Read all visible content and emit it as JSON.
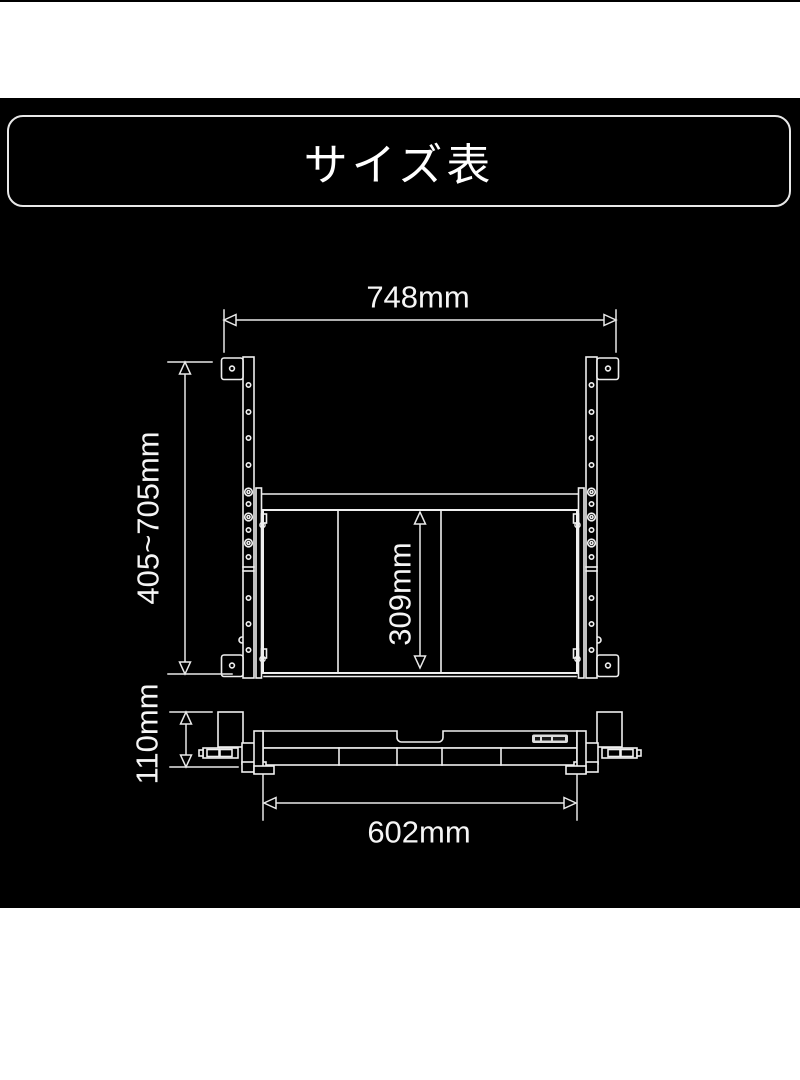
{
  "title": "サイズ表",
  "diagram": {
    "front_view": {
      "overall_width_label": "748mm",
      "height_range_label": "405~705mm",
      "tray_depth_label": "309mm"
    },
    "side_view": {
      "bracket_height_label": "110mm",
      "tray_width_label": "602mm"
    },
    "colors": {
      "background": "#000000",
      "line": "#efefef",
      "page_margin": "#ffffff"
    }
  }
}
